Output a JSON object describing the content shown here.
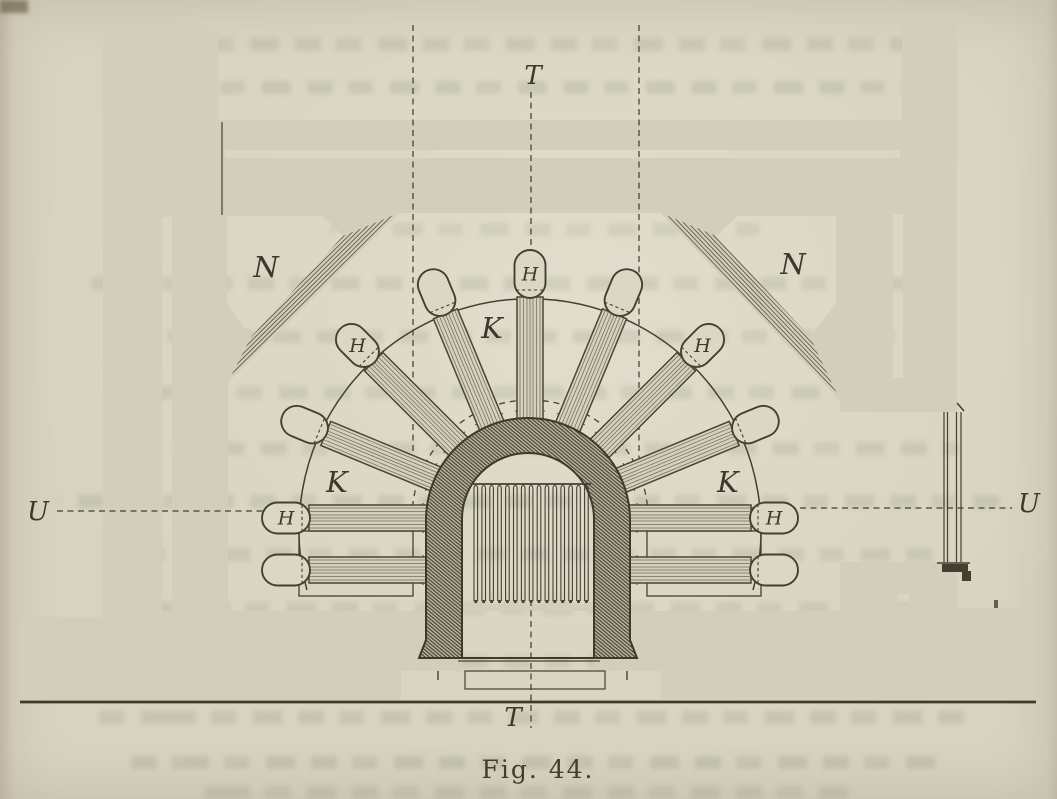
{
  "page": {
    "caption": "Fig. 44."
  },
  "diagram": {
    "labels": {
      "niche_left": "N",
      "niche_right": "N",
      "flue_left": "K",
      "flue_top": "K",
      "flue_right": "K",
      "tube_cap": "H",
      "section_vertical_top": "T",
      "section_vertical_bottom": "T",
      "section_horizontal_left": "U",
      "section_horizontal_right": "U"
    },
    "tube_fan": {
      "radial_angles_deg": [
        0,
        22.5,
        45,
        67.5,
        90,
        112.5,
        135,
        157.5,
        180
      ],
      "h_labeled_angles_deg": [
        0,
        45,
        90,
        135,
        180
      ],
      "lower_horizontal_tubes": 2,
      "total_tubes": 11
    },
    "grate_bar_count": 15,
    "colors": {
      "paper": "#d8d2c0",
      "ink": "#453f32",
      "hatch_line": "#565040",
      "masonry_fill": "#d3cdbb",
      "arch_fill": "#b9b3a1"
    }
  }
}
